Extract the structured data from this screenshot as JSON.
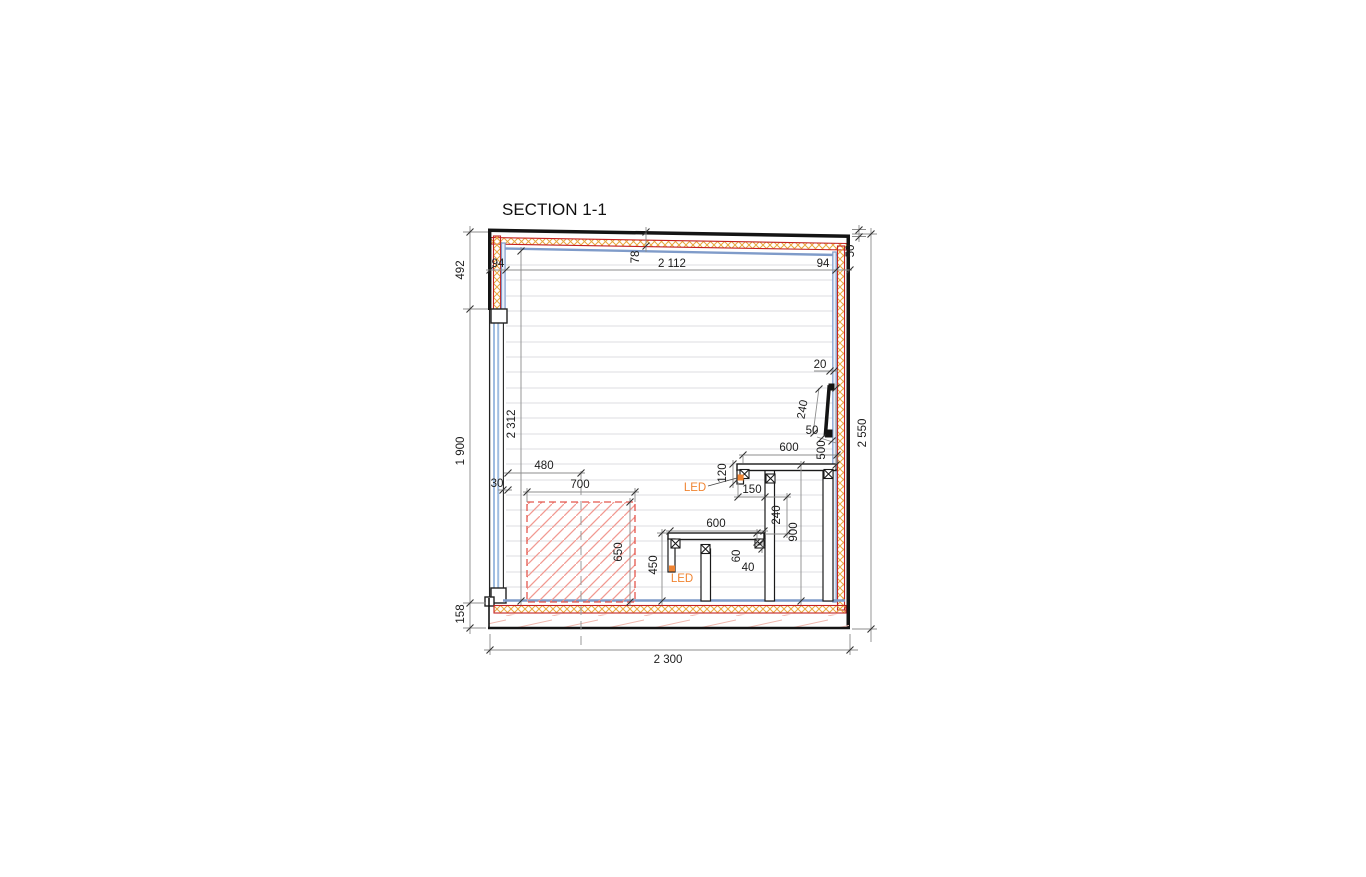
{
  "drawing": {
    "title": "SECTION 1-1",
    "dims": {
      "left_top": "492",
      "wall_left": "94",
      "interior_width": "2 112",
      "wall_right": "94",
      "roof_thickness": "78",
      "roof_edge": "50",
      "total_height": "2 550",
      "interior_height": "2 312",
      "door_height": "1 900",
      "floor_thickness": "158",
      "total_width": "2 300",
      "heater_center": "480",
      "door_gap": "30",
      "heater_width": "700",
      "heater_height": "650",
      "backrest_gap_top": "20",
      "backrest_length": "240",
      "backrest_gap_bottom": "50",
      "backrest_above_bench": "500",
      "bench_upper_width": "600",
      "bench_upper_thickness": "120",
      "bench_upper_height": "900",
      "bench_overhang": "150",
      "bench_level_gap": "240",
      "bench_lower_width": "600",
      "bench_lower_height": "450",
      "bench_board": "60",
      "bench_frame": "40",
      "led": "LED"
    },
    "colors": {
      "line_red": "#c42222",
      "insulation_orange": "#e8a83f",
      "lining_blue": "#7f9bc9",
      "led_orange": "#f08432",
      "heater_red": "#e4574d",
      "dim_gray": "#8c8c8c"
    }
  }
}
